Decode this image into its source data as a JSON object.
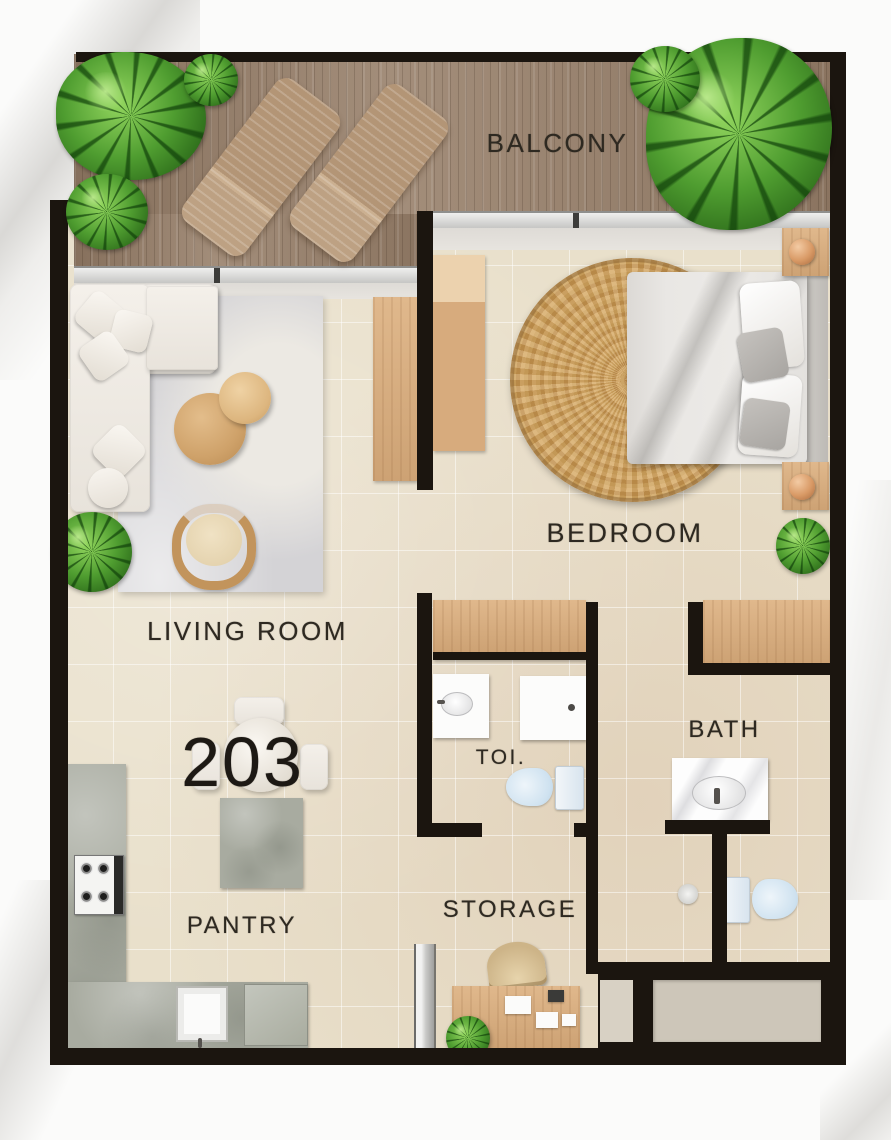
{
  "title": "Apartment floor plan",
  "unit_number": "203",
  "labels": {
    "balcony": "BALCONY",
    "bedroom": "BEDROOM",
    "living_room": "LIVING ROOM",
    "pantry": "PANTRY",
    "toilet": "TOI.",
    "bath": "BATH",
    "storage": "STORAGE"
  },
  "colors": {
    "wall": "#1b150f",
    "floor_tile": "#e9e0cb",
    "deck_wood": "#9b846f",
    "furniture_wood": "#d7ab7d",
    "kitchen_counter": "#a8aba0",
    "living_rug": "#d4d3d6",
    "round_rug": "#cda05e",
    "toilet_fixture": "#cfe2f0",
    "plant_green": "#4f9d30",
    "label_text": "#2e2921"
  },
  "furniture": [
    "lounge-chairs",
    "l-shaped-sofa",
    "coffee-poufs",
    "rattan-armchair",
    "round-rug",
    "double-bed",
    "nightstands-with-lamps",
    "dresser-console",
    "wardrobe-closets",
    "dining-table",
    "kitchen-island",
    "stove",
    "kitchen-sink",
    "washbasin",
    "vanity-sink",
    "toilets",
    "storage-desk",
    "plants"
  ]
}
